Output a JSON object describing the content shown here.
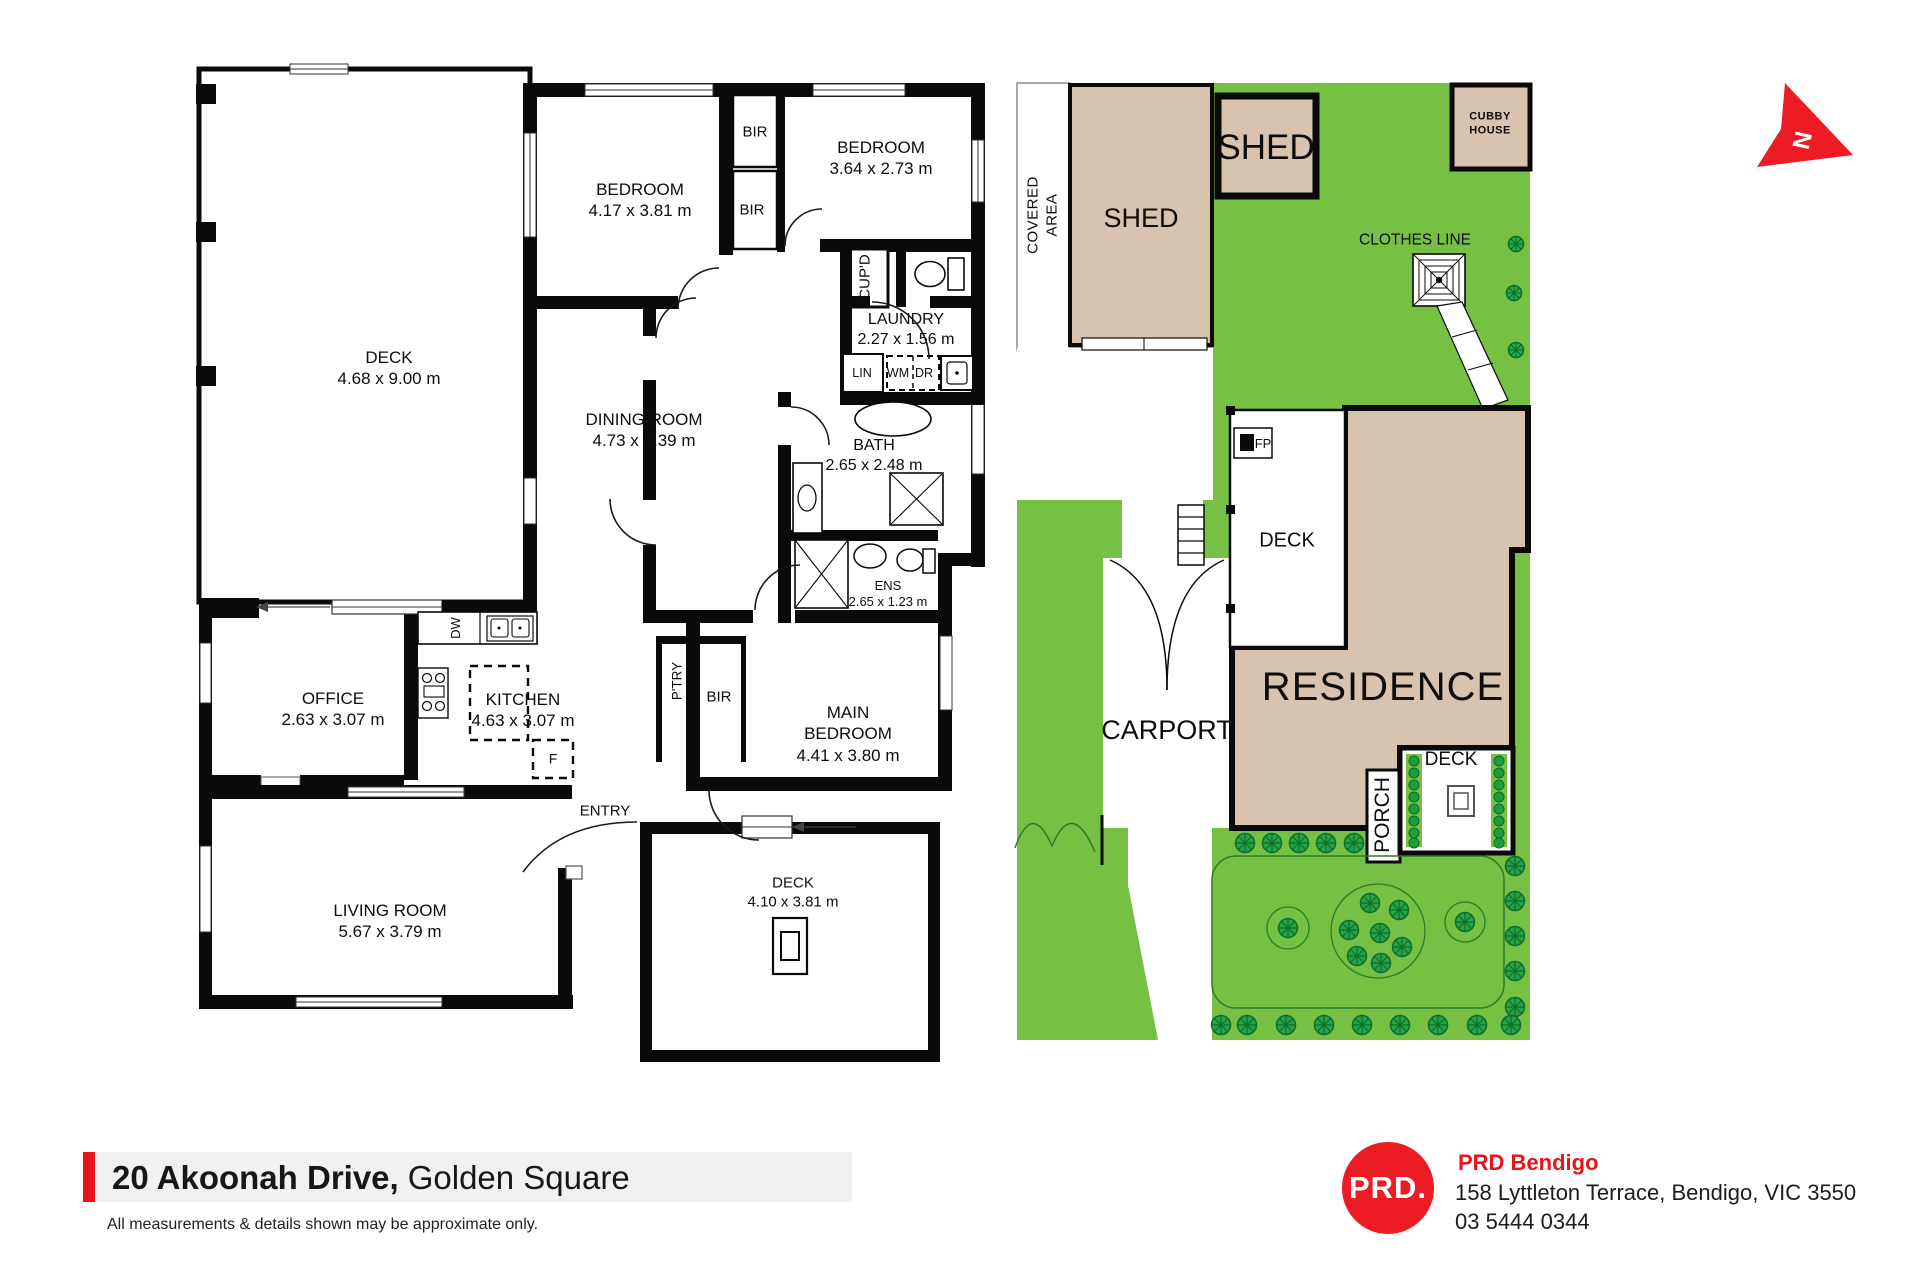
{
  "floor_plan": {
    "deck_top": {
      "name": "DECK",
      "dims": "4.68 x 9.00 m"
    },
    "bedroom1": {
      "name": "BEDROOM",
      "dims": "4.17 x 3.81 m"
    },
    "bedroom2": {
      "name": "BEDROOM",
      "dims": "3.64 x 2.73 m"
    },
    "dining_room": {
      "name": "DINING ROOM",
      "dims": "4.73 x 5.39 m"
    },
    "laundry": {
      "name": "LAUNDRY",
      "dims": "2.27 x 1.56 m"
    },
    "bath": {
      "name": "BATH",
      "dims": "2.65 x 2.48 m"
    },
    "ensuite": {
      "name": "ENS",
      "dims": "2.65 x 1.23 m"
    },
    "office": {
      "name": "OFFICE",
      "dims": "2.63 x 3.07 m"
    },
    "kitchen": {
      "name": "KITCHEN",
      "dims": "4.63 x 3.07 m"
    },
    "main_bedroom": {
      "line1": "MAIN",
      "line2": "BEDROOM",
      "dims": "4.41 x 3.80 m"
    },
    "living_room": {
      "name": "LIVING ROOM",
      "dims": "5.67 x 3.79 m"
    },
    "deck_bottom": {
      "name": "DECK",
      "dims": "4.10 x 3.81 m"
    },
    "entry": "ENTRY",
    "fixtures": {
      "bir": "BIR",
      "cupboard": "CUP'D",
      "linen": "LIN",
      "washing_machine": "WM",
      "dryer": "DR",
      "dishwasher": "DW",
      "fridge": "F",
      "pantry": "P'TRY"
    }
  },
  "site_plan": {
    "covered_area": {
      "line1": "COVERED",
      "line2": "AREA"
    },
    "shed_large": "SHED",
    "shed_small": "SHED",
    "cubby_house": {
      "line1": "CUBBY",
      "line2": "HOUSE"
    },
    "clothes_line": "CLOTHES LINE",
    "fireplace": "FP",
    "deck_upper": "DECK",
    "residence": "RESIDENCE",
    "carport": "CARPORT",
    "porch": "PORCH",
    "deck_lower": "DECK"
  },
  "compass": {
    "north": "N"
  },
  "footer": {
    "address_bold": "20 Akoonah Drive,",
    "address_light": "Golden Square",
    "disclaimer": "All measurements & details shown may be approximate only.",
    "agency": {
      "logo_text": "PRD.",
      "name": "PRD Bendigo",
      "street": "158 Lyttleton Terrace, Bendigo, VIC 3550",
      "phone": "03 5444 0344"
    }
  },
  "colors": {
    "lawn_green": "#76c043",
    "structure_tan": "#d8c3ae",
    "accent_red": "#ed1c24",
    "footer_red": "#e8131b",
    "wall_black": "#0a0a0a",
    "footer_band_grey": "#f1f1f1",
    "shrub_green": "#27a347"
  }
}
